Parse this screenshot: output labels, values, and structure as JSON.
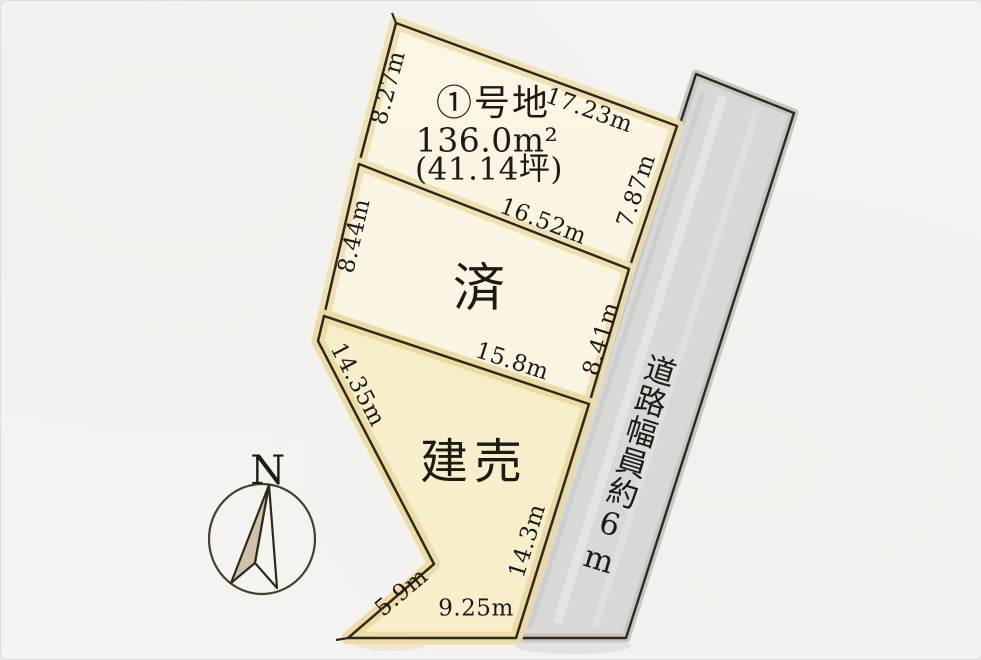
{
  "plot1": {
    "name": "①号地",
    "area": "136.0m²",
    "area_tsubo": "(41.14坪)",
    "dim_left": "8.27m",
    "dim_top": "17.23m",
    "dim_right": "7.87m",
    "dim_bottom": "16.52m"
  },
  "plot2": {
    "status": "済",
    "dim_left": "8.44m",
    "dim_right": "8.41m",
    "dim_bottom": "15.8m"
  },
  "plot3": {
    "status": "建売",
    "dim_upper_left": "14.35m",
    "dim_lower_left": "5.9m",
    "dim_bottom": "9.25m",
    "dim_right": "14.3m"
  },
  "road": {
    "label": "道路幅員約6m"
  },
  "compass": {
    "label": "N"
  },
  "colors": {
    "paper": "#f4f3ef",
    "plot_fill": "#fbf5e3",
    "plot_fill_warm": "#f8eecb",
    "watercolor_edge": "#eee1b2",
    "road_fill": "#d8d8d6",
    "outline": "#2e281f",
    "text": "#1d1a13"
  }
}
